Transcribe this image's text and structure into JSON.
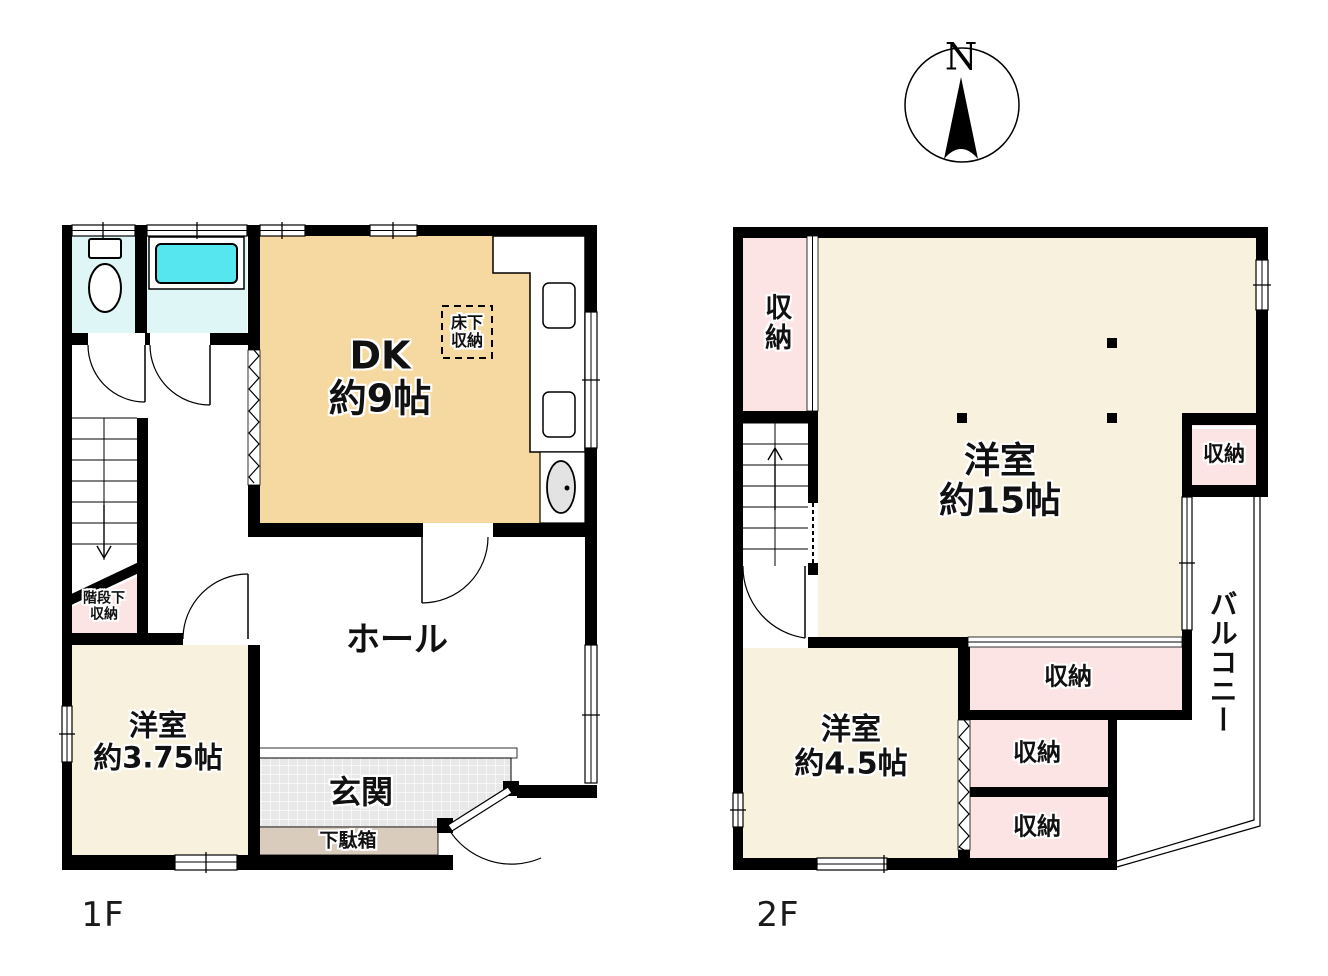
{
  "document_type": "floor-plan",
  "compass": {
    "label": "N"
  },
  "colors": {
    "wall": "#000000",
    "dk_tan": "#F6D9A1",
    "room_cream": "#F8F1DE",
    "closet_pink": "#FBE4E3",
    "wet_area_cyan": "#DFF6F7",
    "bathtub_cyan": "#56E6F0",
    "entrance_tile": "#E8E8E8",
    "shoe_cabinet_tan": "#D9CCBD",
    "basin_gray": "#E3E3E3"
  },
  "floor1": {
    "name_label": "1F",
    "rooms": {
      "dk": "DK\n約9帖",
      "underfloor_storage": "床下\n収納",
      "hall": "ホール",
      "entrance": "玄関",
      "shoe_cabinet": "下駄箱",
      "under_stairs_storage": "階段下\n収納",
      "western_room_375": "洋室\n約3.75帖"
    }
  },
  "floor2": {
    "name_label": "2F",
    "rooms": {
      "closet_top_left": "収納",
      "western_room_15": "洋室\n約15帖",
      "closet_right": "収納",
      "balcony": "バルコニー",
      "closet_1": "収納",
      "closet_2": "収納",
      "closet_3": "収納",
      "western_room_45": "洋室\n約4.5帖"
    }
  }
}
